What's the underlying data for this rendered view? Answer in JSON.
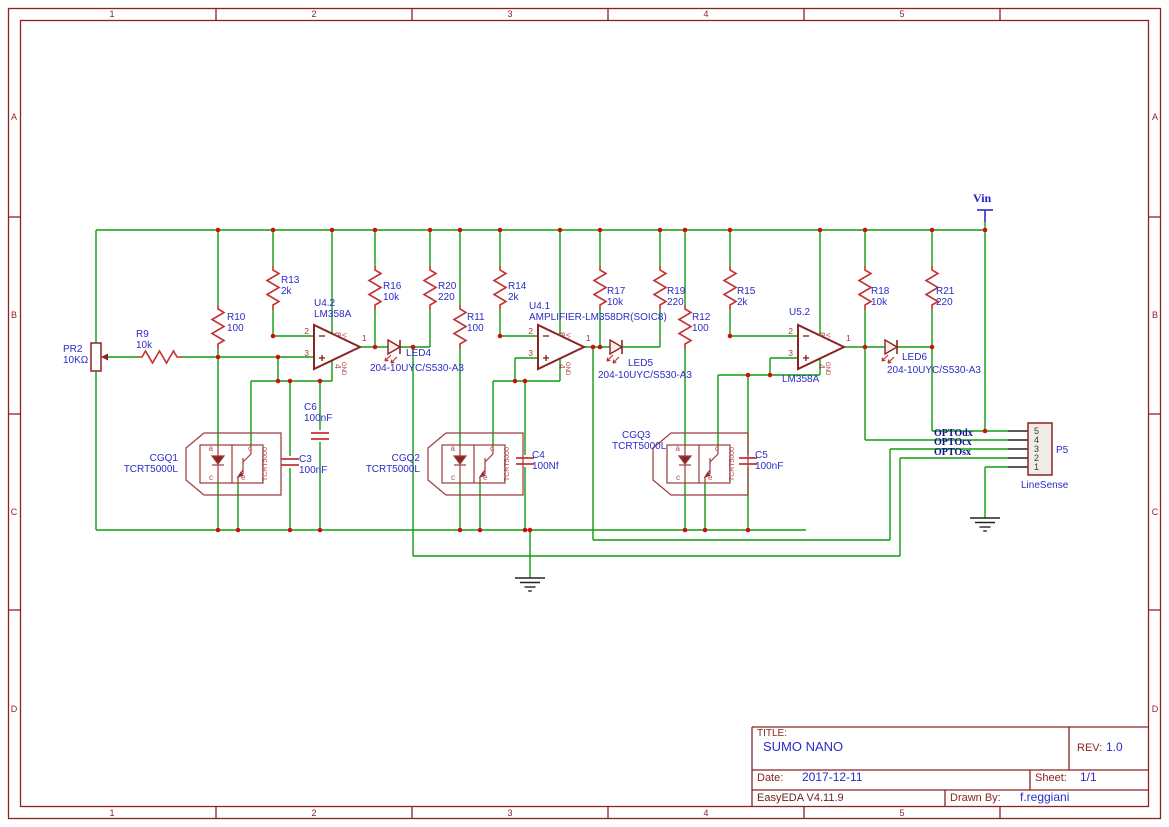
{
  "frame": {
    "cols": [
      "1",
      "2",
      "3",
      "4",
      "5"
    ],
    "rows": [
      "A",
      "B",
      "C",
      "D"
    ]
  },
  "power": {
    "vin": "Vin"
  },
  "nets": {
    "optodx": "OPTOdx",
    "optocx": "OPTOcx",
    "optosx": "OPTOsx"
  },
  "opamp": {
    "pin_inv": "2",
    "pin_nin": "3",
    "pin_out": "1",
    "pin_vcc": "8",
    "pin_gnd": "4",
    "vcc": "V+",
    "gnd": "GND"
  },
  "sensor": {
    "a": "a",
    "c": "c",
    "e": "e",
    "inner": "TCRT5000"
  },
  "p5": {
    "ref": "P5",
    "value": "LineSense",
    "pins": [
      "5",
      "4",
      "3",
      "2",
      "1"
    ]
  },
  "components": {
    "pr2": {
      "ref": "PR2",
      "value": "10KΩ"
    },
    "r9": {
      "ref": "R9",
      "value": "10k"
    },
    "r10": {
      "ref": "R10",
      "value": "100"
    },
    "r11": {
      "ref": "R11",
      "value": "100"
    },
    "r12": {
      "ref": "R12",
      "value": "100"
    },
    "r13": {
      "ref": "R13",
      "value": "2k"
    },
    "r14": {
      "ref": "R14",
      "value": "2k"
    },
    "r15": {
      "ref": "R15",
      "value": "2k"
    },
    "r16": {
      "ref": "R16",
      "value": "10k"
    },
    "r17": {
      "ref": "R17",
      "value": "10k"
    },
    "r18": {
      "ref": "R18",
      "value": "10k"
    },
    "r19": {
      "ref": "R19",
      "value": "220"
    },
    "r20": {
      "ref": "R20",
      "value": "220"
    },
    "r21": {
      "ref": "R21",
      "value": "220"
    },
    "u42": {
      "ref": "U4.2",
      "value": "LM358A"
    },
    "u41": {
      "ref": "U4.1",
      "value": "AMPLIFIER-LM358DR(SOIC8)"
    },
    "u52": {
      "ref": "U5.2",
      "value": "LM358A"
    },
    "led4": {
      "ref": "LED4",
      "value": "204-10UYC/S530-A3"
    },
    "led5": {
      "ref": "LED5",
      "value": "204-10UYC/S530-A3"
    },
    "led6": {
      "ref": "LED6",
      "value": "204-10UYC/S530-A3"
    },
    "c3": {
      "ref": "C3",
      "value": "100nF"
    },
    "c4": {
      "ref": "C4",
      "value": "100Nf"
    },
    "c5": {
      "ref": "C5",
      "value": "100nF"
    },
    "c6": {
      "ref": "C6",
      "value": "100nF"
    },
    "cgq1": {
      "ref": "CGQ1",
      "value": "TCRT5000L"
    },
    "cgq2": {
      "ref": "CGQ2",
      "value": "TCRT5000L"
    },
    "cgq3": {
      "ref": "CGQ3",
      "value": "TCRT5000L"
    }
  },
  "title_block": {
    "title_label": "TITLE:",
    "title": "SUMO NANO",
    "rev_label": "REV:",
    "rev": "1.0",
    "date_label": "Date:",
    "date": "2017-12-11",
    "sheet_label": "Sheet:",
    "sheet": "1/1",
    "tool": "EasyEDA V4.11.9",
    "drawn_by_label": "Drawn By:",
    "drawn_by": "f.reggiani"
  }
}
